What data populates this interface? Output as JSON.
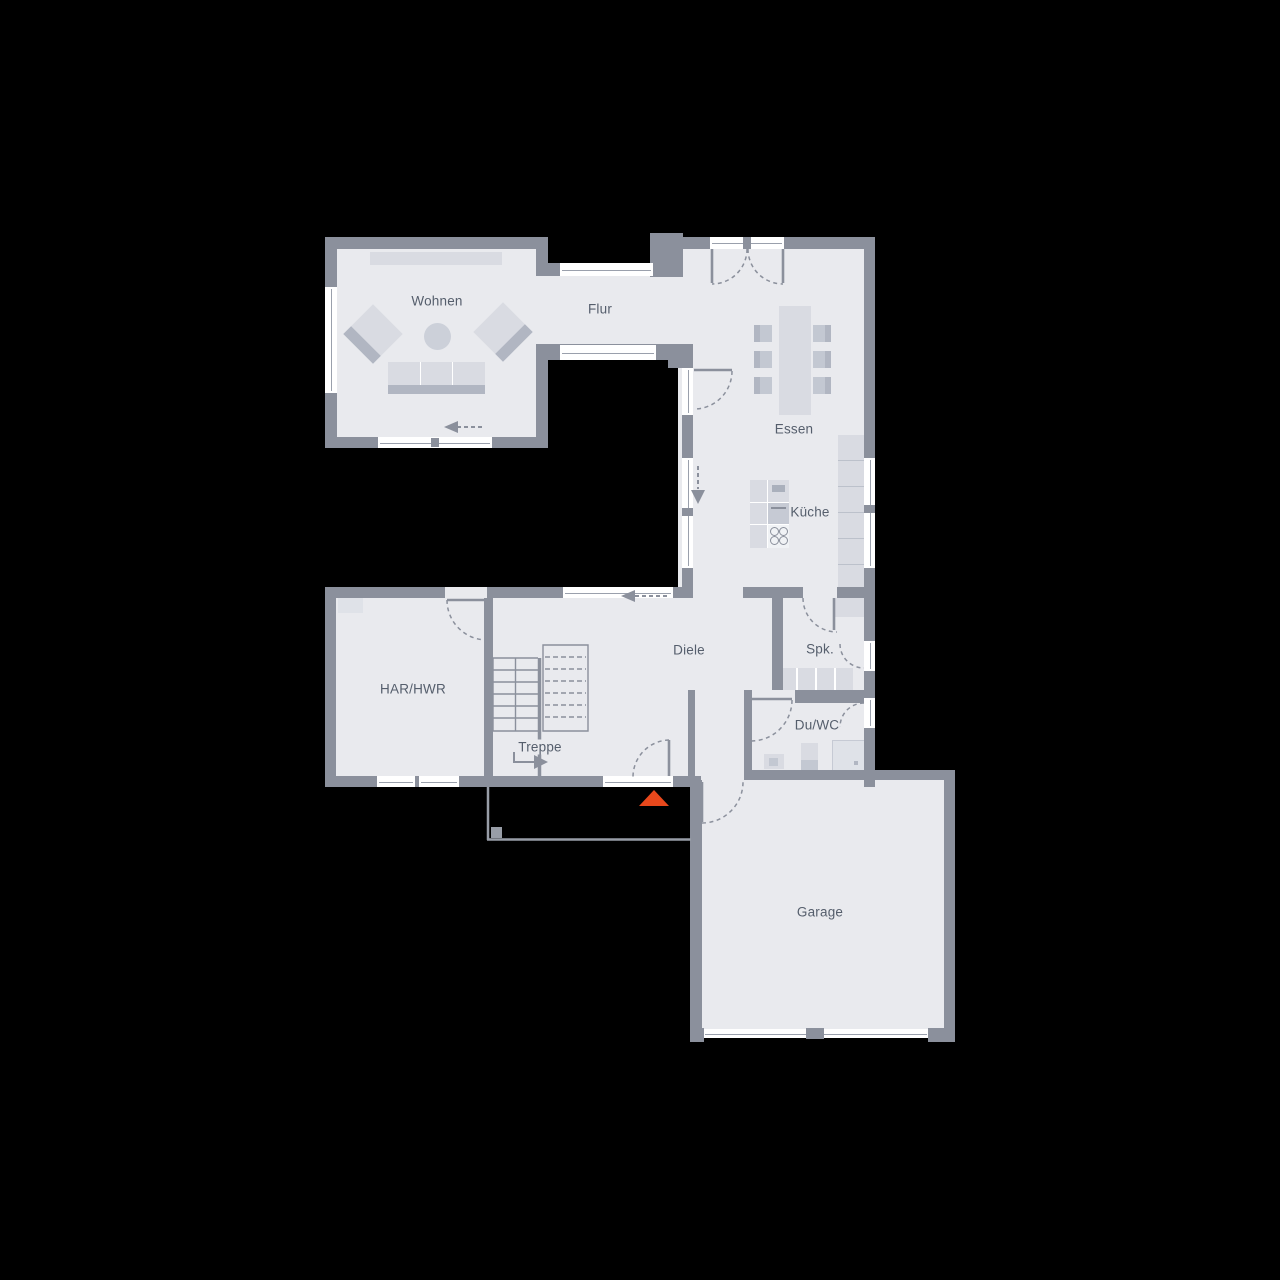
{
  "meta": {
    "type": "floor-plan",
    "floor": "ground-floor",
    "background": "#000000"
  },
  "colors": {
    "wall": "#8b909c",
    "floor": "#e9eaee",
    "window": "#ffffff",
    "furniture_light": "#d9dbe2",
    "furniture_mid": "#c3c8d2",
    "furniture_dark": "#b1b6c2",
    "line": "#8b909c",
    "text": "#555e6c",
    "entrance_marker": "#e8481c"
  },
  "rooms": {
    "wohnen": {
      "label": "Wohnen"
    },
    "flur": {
      "label": "Flur"
    },
    "essen": {
      "label": "Essen"
    },
    "kueche": {
      "label": "Küche"
    },
    "diele": {
      "label": "Diele"
    },
    "spk": {
      "label": "Spk."
    },
    "duwc": {
      "label": "Du/WC"
    },
    "har": {
      "label": "HAR/HWR"
    },
    "treppe": {
      "label": "Treppe"
    },
    "garage": {
      "label": "Garage"
    }
  },
  "markers": {
    "entrance": {
      "icon": "entrance-triangle-icon",
      "color": "#e8481c"
    }
  },
  "annotations": {
    "flow_arrows": [
      {
        "name": "flow-arrow-wohnen",
        "direction": "left"
      },
      {
        "name": "flow-arrow-kueche",
        "direction": "down"
      },
      {
        "name": "flow-arrow-diele",
        "direction": "left"
      },
      {
        "name": "stair-direction-arrow",
        "direction": "right"
      }
    ],
    "furniture": [
      "sideboard",
      "armchair",
      "armchair",
      "coffee-table",
      "sofa",
      "dining-table",
      "dining-chairs-6",
      "kitchen-island",
      "cooktop-burners-4",
      "kitchen-counter",
      "pantry-shelves",
      "toilet",
      "washbasin",
      "shower",
      "stairs-solid-flight",
      "stairs-dashed-flight"
    ]
  }
}
